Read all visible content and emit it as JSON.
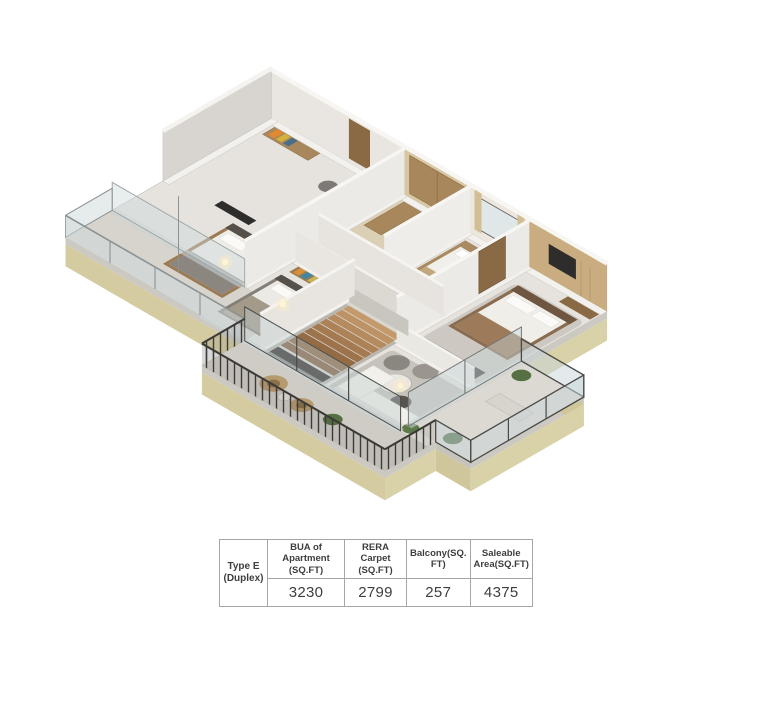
{
  "palette": {
    "background": "#ffffff",
    "slab_khaki": "#d9d1a8",
    "slab_edge_gray": "#ccc9c3",
    "wall_gray": "#d8d5d0",
    "wall_white": "#f2f1ee",
    "floor": "#e6e3de",
    "accent_wood": "#a9875c",
    "accent_tan_wall": "#c9ad80",
    "railing_dark": "#3c3a37",
    "glass": "#ccd8da",
    "plant_green": "#567043",
    "stair_wood": "#b5885a",
    "table_border": "#a6a6a6",
    "table_text": "#3e3e3e"
  },
  "table": {
    "row_label": "Type E\n(Duplex)",
    "columns": [
      {
        "label": "BUA of Apartment (SQ.FT)",
        "value": "3230"
      },
      {
        "label": "RERA Carpet (SQ.FT)",
        "value": "2799"
      },
      {
        "label": "Balcony(SQ. FT)",
        "value": "257"
      },
      {
        "label": "Saleable Area(SQ.FT)",
        "value": "4375"
      }
    ]
  }
}
